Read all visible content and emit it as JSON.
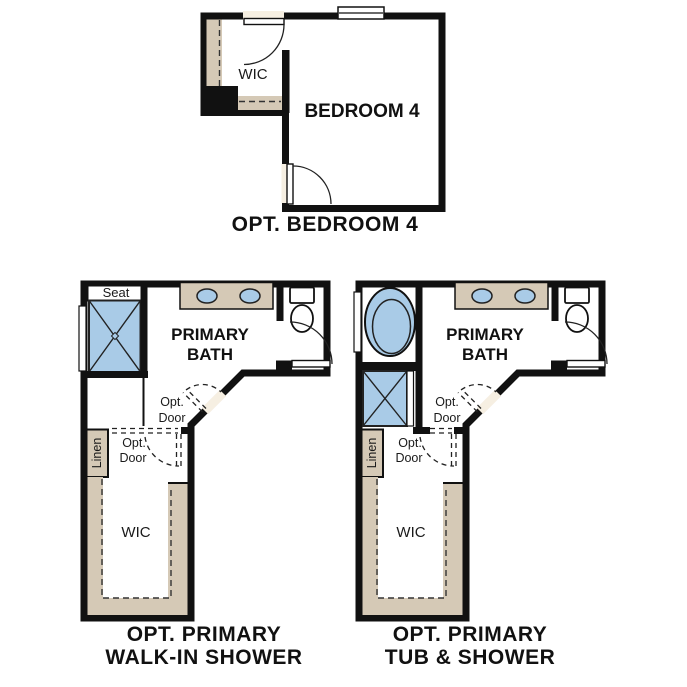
{
  "colors": {
    "wall": "#111111",
    "floor": "#f6efe2",
    "shelf": "#d5c9b6",
    "fixture_blue": "#a9cbe7",
    "background": "#ffffff"
  },
  "plans": {
    "bedroom4": {
      "wic_label": "WIC",
      "room_label": "BEDROOM 4",
      "caption": "OPT. BEDROOM 4"
    },
    "walk_in_shower": {
      "seat_label": "Seat",
      "room_label_line1": "PRIMARY",
      "room_label_line2": "BATH",
      "opt_door_upper_line1": "Opt.",
      "opt_door_upper_line2": "Door",
      "opt_door_lower_line1": "Opt.",
      "opt_door_lower_line2": "Door",
      "linen_label": "Linen",
      "wic_label": "WIC",
      "caption_line1": "OPT. PRIMARY",
      "caption_line2": "WALK-IN SHOWER"
    },
    "tub_shower": {
      "room_label_line1": "PRIMARY",
      "room_label_line2": "BATH",
      "opt_door_upper_line1": "Opt.",
      "opt_door_upper_line2": "Door",
      "opt_door_lower_line1": "Opt.",
      "opt_door_lower_line2": "Door",
      "linen_label": "Linen",
      "wic_label": "WIC",
      "caption_line1": "OPT. PRIMARY",
      "caption_line2": "TUB & SHOWER"
    }
  }
}
